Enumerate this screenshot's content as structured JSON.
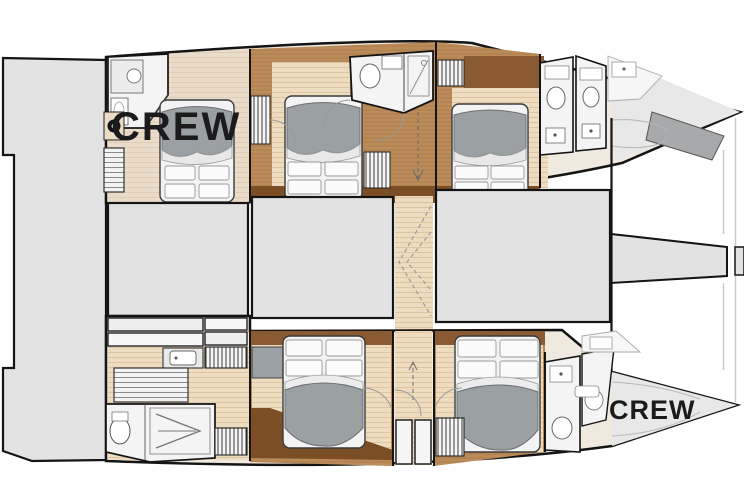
{
  "plan": {
    "labels": {
      "crew_aft_port": "CREW",
      "crew_forward_starboard": "CREW"
    },
    "colors": {
      "outline": "#141414",
      "deck_gray": "#e3e3e3",
      "hull_fill": "#efe9e0",
      "floor_tan": "#eedcc0",
      "floor_tan_stripe": "#ddc5a2",
      "crew_floor_tan": "#ebdcca",
      "wood_medium": "#bb8b59",
      "wood_dark": "#7c4e26",
      "wood_band": "#8a5a32",
      "bed_duvet_gray": "#9ba0a3",
      "linen_white": "#f8f8f8",
      "bath_white": "#f4f4f4",
      "bow_gray": "#e8e8e8",
      "crew_text": "#1b1b1b"
    }
  }
}
